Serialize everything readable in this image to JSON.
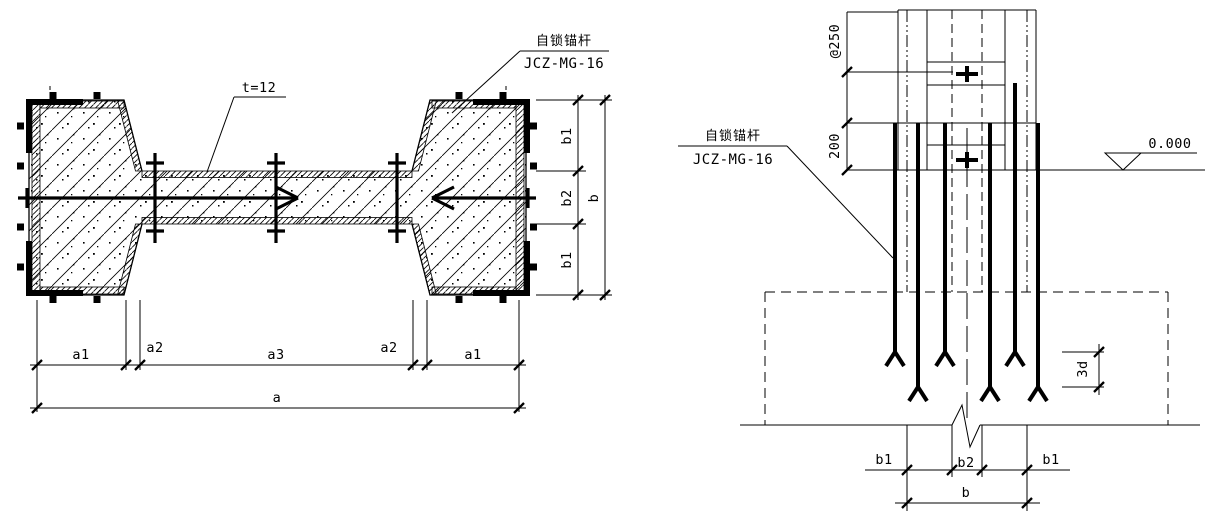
{
  "drawing": {
    "background": "#ffffff",
    "line_color": "#000000",
    "left_view": {
      "anchor_label": {
        "cn": "自锁锚杆",
        "code": "JCZ-MG-16"
      },
      "web_thickness": "t=12",
      "dims": {
        "a1": "a1",
        "a2": "a2",
        "a3": "a3",
        "a": "a",
        "b1": "b1",
        "b2": "b2",
        "b": "b"
      }
    },
    "right_view": {
      "anchor_label": {
        "cn": "自锁锚杆",
        "code": "JCZ-MG-16"
      },
      "dims": {
        "spacing": "@250",
        "depth": "200",
        "stagger": "3d",
        "b1": "b1",
        "b2": "b2",
        "b": "b"
      },
      "level_mark": "0.000"
    }
  }
}
